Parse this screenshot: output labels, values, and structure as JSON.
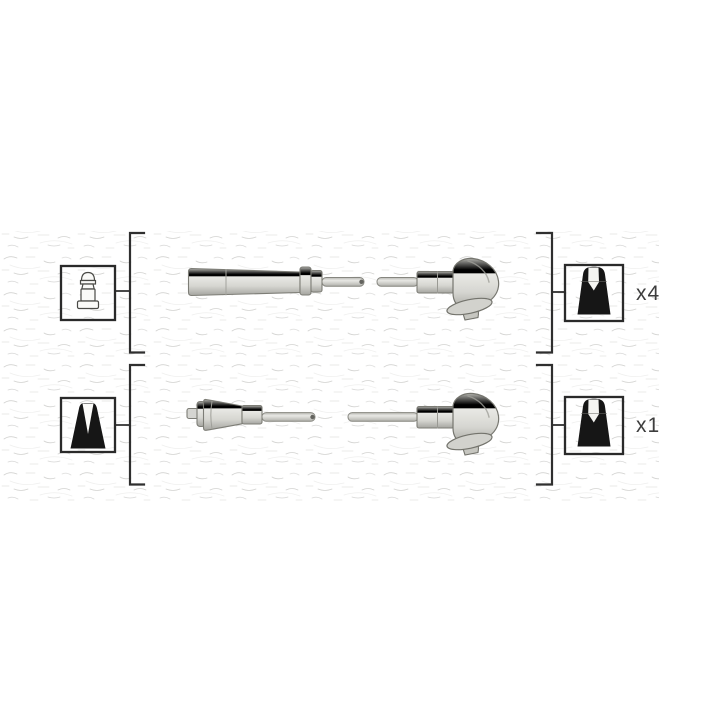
{
  "rows": [
    {
      "name": "ignition-cable-set-main",
      "left_icon": "spark-plug-terminal-icon",
      "right_icon": "spark-plug-boot-icon",
      "quantity_label": "x4"
    },
    {
      "name": "ignition-cable-coil-lead",
      "left_icon": "coil-boot-icon",
      "right_icon": "spark-plug-boot-icon",
      "quantity_label": "x1"
    }
  ],
  "colors": {
    "background": "#ffffff",
    "line": "#2f2f2f",
    "icon_fill": "#161616",
    "label_text": "#3d3d3d",
    "watermark": "#a5a5a2",
    "part_outline": "#7d7d76",
    "part_light": "#efefeb",
    "part_dark": "#a9a9a3"
  }
}
